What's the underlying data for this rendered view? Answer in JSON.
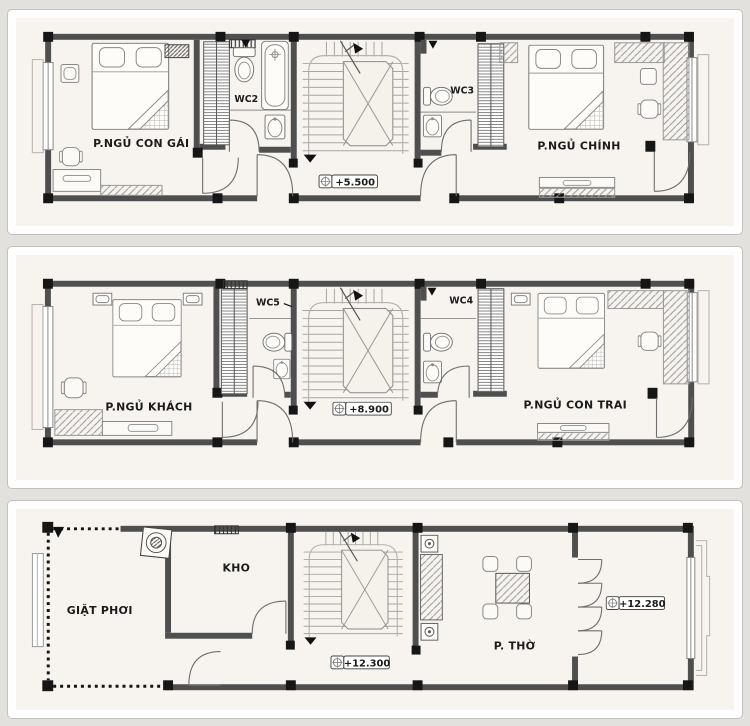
{
  "colors": {
    "page_background": "#e3e1de",
    "card_background": "#ffffff",
    "paper_background": "#f7f4ef",
    "wall": "#4f4f4f",
    "column": "#161616",
    "line": "#8a8a8a",
    "text": "#1b1b1b"
  },
  "plans": [
    {
      "id": "plan-level-3",
      "elevation": "+5.500",
      "rooms": {
        "left_bedroom": "P.NGỦ CON GÁI",
        "wc_left": "WC2",
        "wc_right": "WC3",
        "right_bedroom": "P.NGỦ CHÍNH"
      }
    },
    {
      "id": "plan-level-4",
      "elevation": "+8.900",
      "rooms": {
        "left_bedroom": "P.NGỦ KHÁCH",
        "wc_left": "WC5",
        "wc_right": "WC4",
        "right_bedroom": "P.NGỦ CON TRAI"
      }
    },
    {
      "id": "plan-level-5",
      "elevation": "+12.300",
      "elevation_secondary": "+12.280",
      "rooms": {
        "laundry": "GIẶT PHƠI",
        "storage": "KHO",
        "worship": "P. THỜ"
      }
    }
  ]
}
